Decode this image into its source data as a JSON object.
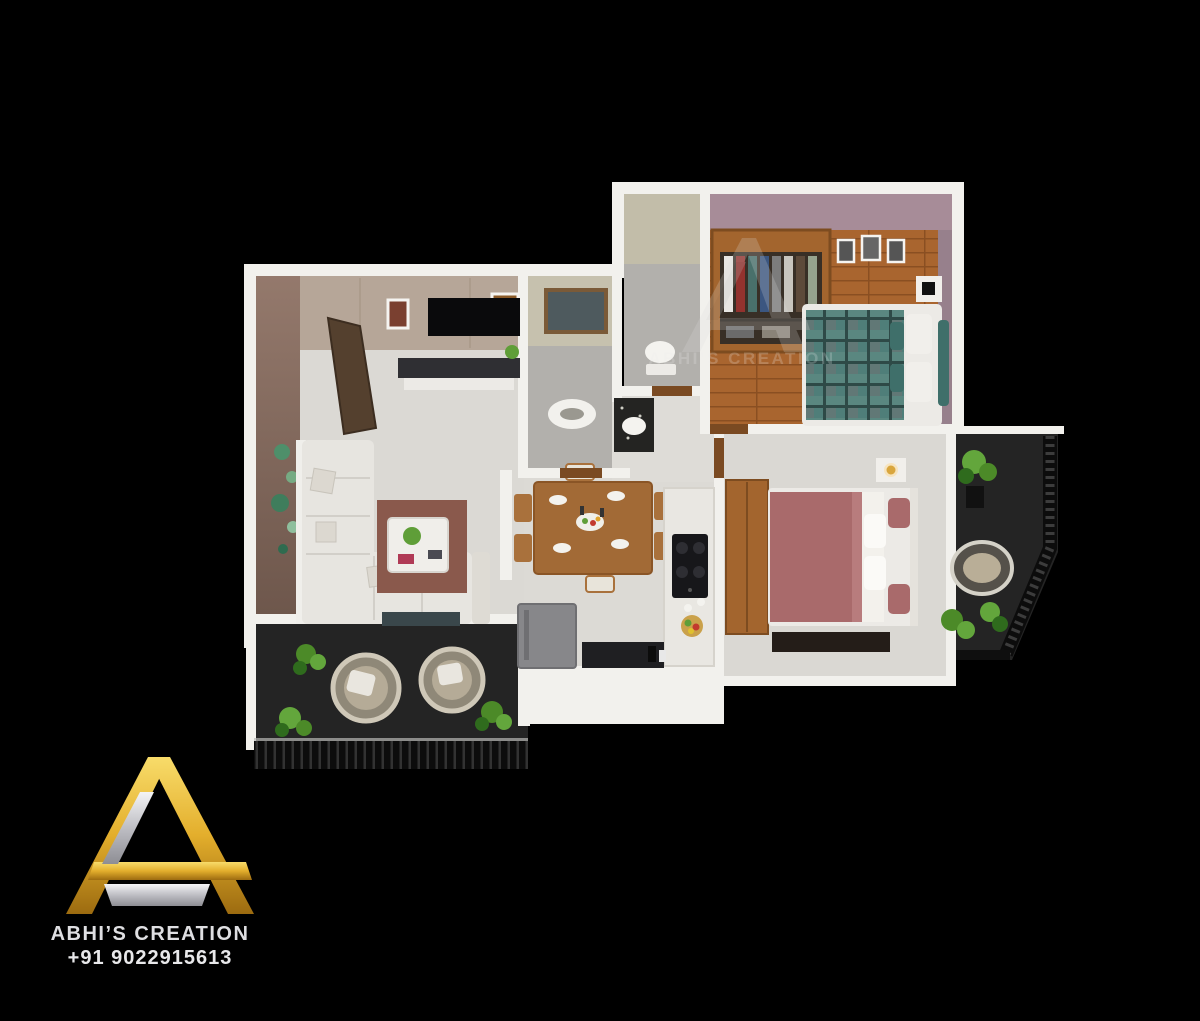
{
  "canvas": {
    "width": 1200,
    "height": 1021,
    "background": "#000000"
  },
  "watermark": {
    "text": "ABHI’S CREATION",
    "opacity": 0.22
  },
  "logo": {
    "title": "ABHI’S CREATION",
    "phone": "+91 9022915613",
    "colors": {
      "gold_light": "#f8dc6a",
      "gold": "#e3ae2c",
      "gold_dark": "#9c6b10",
      "silver_light": "#f4f4f6",
      "silver": "#b9b9bf",
      "silver_dark": "#8e8e94",
      "text": "#dfdfe2"
    }
  },
  "scene": {
    "type": "3d-floor-plan-render",
    "palette": {
      "wall_white": "#f2f1ed",
      "marble_floor": "#dbd9d4",
      "wood_floor": "#a9652f",
      "balcony_floor": "#242424",
      "living_left_wall": "#8c7164",
      "living_back_wall": "#b6a698",
      "bedroom_wall": "#a78c98",
      "bathroom_wall": "#c6c1ae",
      "bathroom_floor": "#b2b0ac",
      "rug": "#8a594c",
      "sofa": "#e7e5e0",
      "bed_teal": "#4f7e79",
      "bed_rose": "#a96a6b",
      "wood_furniture": "#a3652e",
      "plant": "#5f9e38"
    },
    "rooms": [
      {
        "name": "living-room",
        "furniture": [
          "entrance-door",
          "tv",
          "tv-console",
          "wall-frames",
          "wall-plates",
          "table-lamp",
          "l-shaped-sofa",
          "rug",
          "coffee-table"
        ]
      },
      {
        "name": "dining-area",
        "furniture": [
          "six-seater-table",
          "plates",
          "platter"
        ]
      },
      {
        "name": "kitchen",
        "furniture": [
          "hob-counter",
          "fruit-basket",
          "refrigerator",
          "lower-counter"
        ]
      },
      {
        "name": "bathroom-1",
        "furniture": [
          "squat-toilet",
          "window"
        ]
      },
      {
        "name": "bathroom-2",
        "furniture": [
          "toilet",
          "washbasin"
        ]
      },
      {
        "name": "master-bedroom",
        "furniture": [
          "open-wardrobe",
          "plaid-double-bed",
          "bedside-unit",
          "picture-frames",
          "curtain"
        ]
      },
      {
        "name": "bedroom-2",
        "furniture": [
          "rose-double-bed",
          "wardrobe",
          "tv-console",
          "bedside-lamp"
        ]
      },
      {
        "name": "balcony-left",
        "furniture": [
          "wicker-chair",
          "wicker-chair",
          "plants",
          "slat-railing"
        ]
      },
      {
        "name": "balcony-right",
        "furniture": [
          "swing-chair",
          "plants",
          "slat-railing"
        ]
      }
    ]
  }
}
